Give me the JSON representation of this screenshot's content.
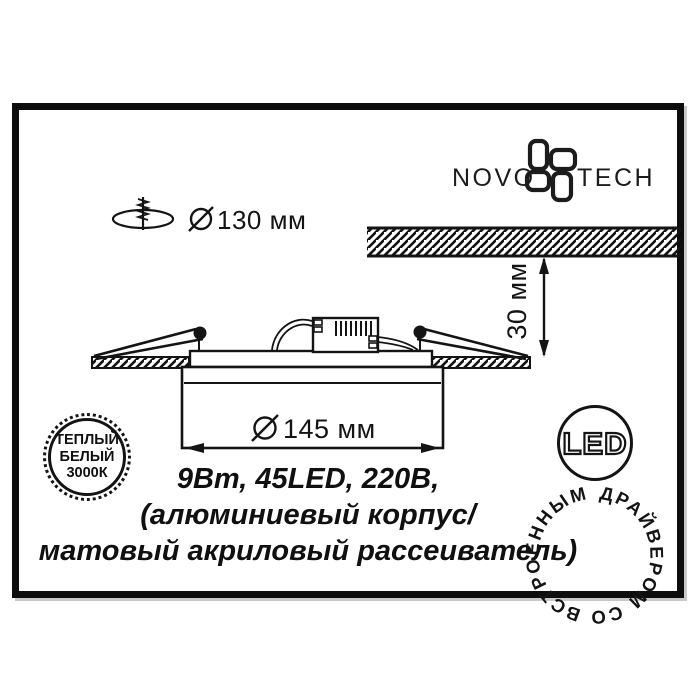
{
  "colors": {
    "ink": "#141414",
    "paper": "#ffffff"
  },
  "logo": {
    "novo": "NOVO",
    "tech": "TECH"
  },
  "cutout": {
    "diameter_label": "130 мм"
  },
  "ceiling": {
    "recess_depth_label": "30 мм"
  },
  "fixture": {
    "diameter_label": "145 мм"
  },
  "specs": {
    "line1": "9Вт, 45LED, 220В,",
    "line2": "(алюминиевый корпус/",
    "line3": "матовый акриловый рассеиватель)"
  },
  "badges": {
    "warm_white": {
      "line1": "ТЕПЛЫЙ",
      "line2": "БЕЛЫЙ",
      "line3": "3000К"
    },
    "led": {
      "label": "LED",
      "ring_text": "ДРАЙВЕРОМ СО ВСТРОЕННЫМ"
    }
  }
}
